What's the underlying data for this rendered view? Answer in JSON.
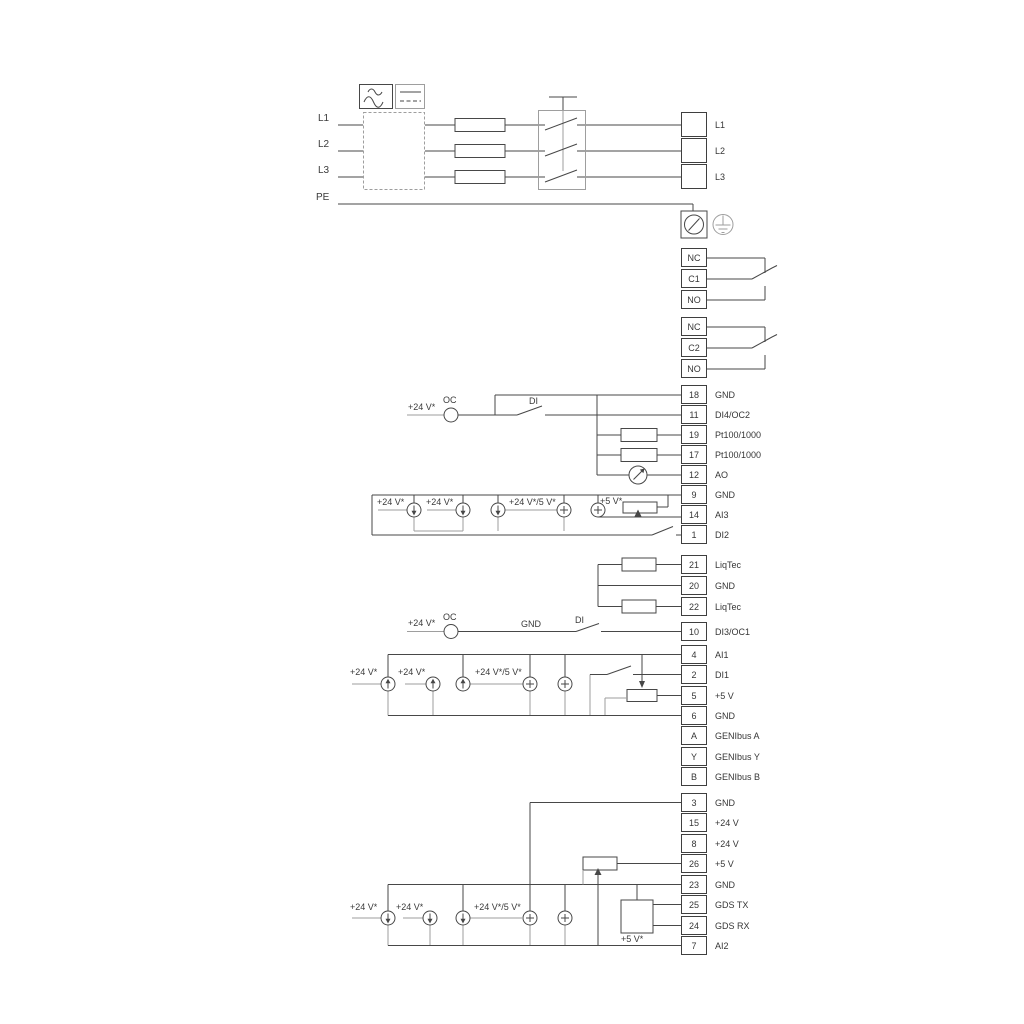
{
  "power": {
    "inputs": {
      "l1": "L1",
      "l2": "L2",
      "l3": "L3",
      "pe": "PE"
    },
    "output_terminals": {
      "rows": [
        {
          "label": "L1"
        },
        {
          "label": "L2"
        },
        {
          "label": "L3"
        }
      ]
    }
  },
  "relays": {
    "relay1": {
      "rows": [
        {
          "num": "NC"
        },
        {
          "num": "C1"
        },
        {
          "num": "NO"
        }
      ]
    },
    "relay2": {
      "rows": [
        {
          "num": "NC"
        },
        {
          "num": "C2"
        },
        {
          "num": "NO"
        }
      ]
    }
  },
  "terminals": {
    "io1": {
      "rows": [
        {
          "num": "18",
          "label": "GND"
        },
        {
          "num": "11",
          "label": "DI4/OC2"
        },
        {
          "num": "19",
          "label": "Pt100/1000"
        },
        {
          "num": "17",
          "label": "Pt100/1000"
        },
        {
          "num": "12",
          "label": "AO"
        },
        {
          "num": "9",
          "label": "GND"
        },
        {
          "num": "14",
          "label": "AI3"
        },
        {
          "num": "1",
          "label": "DI2"
        }
      ]
    },
    "liqtec": {
      "rows": [
        {
          "num": "21",
          "label": "LiqTec"
        },
        {
          "num": "20",
          "label": "GND"
        },
        {
          "num": "22",
          "label": "LiqTec"
        }
      ]
    },
    "di3": {
      "rows": [
        {
          "num": "10",
          "label": "DI3/OC1"
        }
      ]
    },
    "io2": {
      "rows": [
        {
          "num": "4",
          "label": "AI1"
        },
        {
          "num": "2",
          "label": "DI1"
        },
        {
          "num": "5",
          "label": "+5 V"
        },
        {
          "num": "6",
          "label": "GND"
        },
        {
          "num": "A",
          "label": "GENIbus A"
        },
        {
          "num": "Y",
          "label": "GENIbus Y"
        },
        {
          "num": "B",
          "label": "GENIbus B"
        }
      ]
    },
    "io3": {
      "rows": [
        {
          "num": "3",
          "label": "GND"
        },
        {
          "num": "15",
          "label": "+24 V"
        },
        {
          "num": "8",
          "label": "+24 V"
        },
        {
          "num": "26",
          "label": "+5 V"
        },
        {
          "num": "23",
          "label": "GND"
        },
        {
          "num": "25",
          "label": "GDS TX"
        },
        {
          "num": "24",
          "label": "GDS RX"
        },
        {
          "num": "7",
          "label": "AI2"
        }
      ]
    }
  },
  "annotations": {
    "di4_supply": "+24 V*",
    "di4_oc": "OC",
    "di4_di": "DI",
    "ai3_supply1": "+24 V*",
    "ai3_supply2": "+24 V*",
    "ai3_supply45": "+24 V*/5 V*",
    "ai3_5v": "+5 V*",
    "di3_supply": "+24 V*",
    "di3_oc": "OC",
    "di3_gnd": "GND",
    "di3_di": "DI",
    "ai1_supply1": "+24 V*",
    "ai1_supply2": "+24 V*",
    "ai1_supply45": "+24 V*/5 V*",
    "ai2_supply1": "+24 V*",
    "ai2_supply2": "+24 V*",
    "ai2_supply45": "+24 V*/5 V*",
    "gds_5v": "+5 V*"
  },
  "colors": {
    "line_dark": "#474747",
    "line_gray": "#9e9e9e",
    "text": "#363636"
  }
}
